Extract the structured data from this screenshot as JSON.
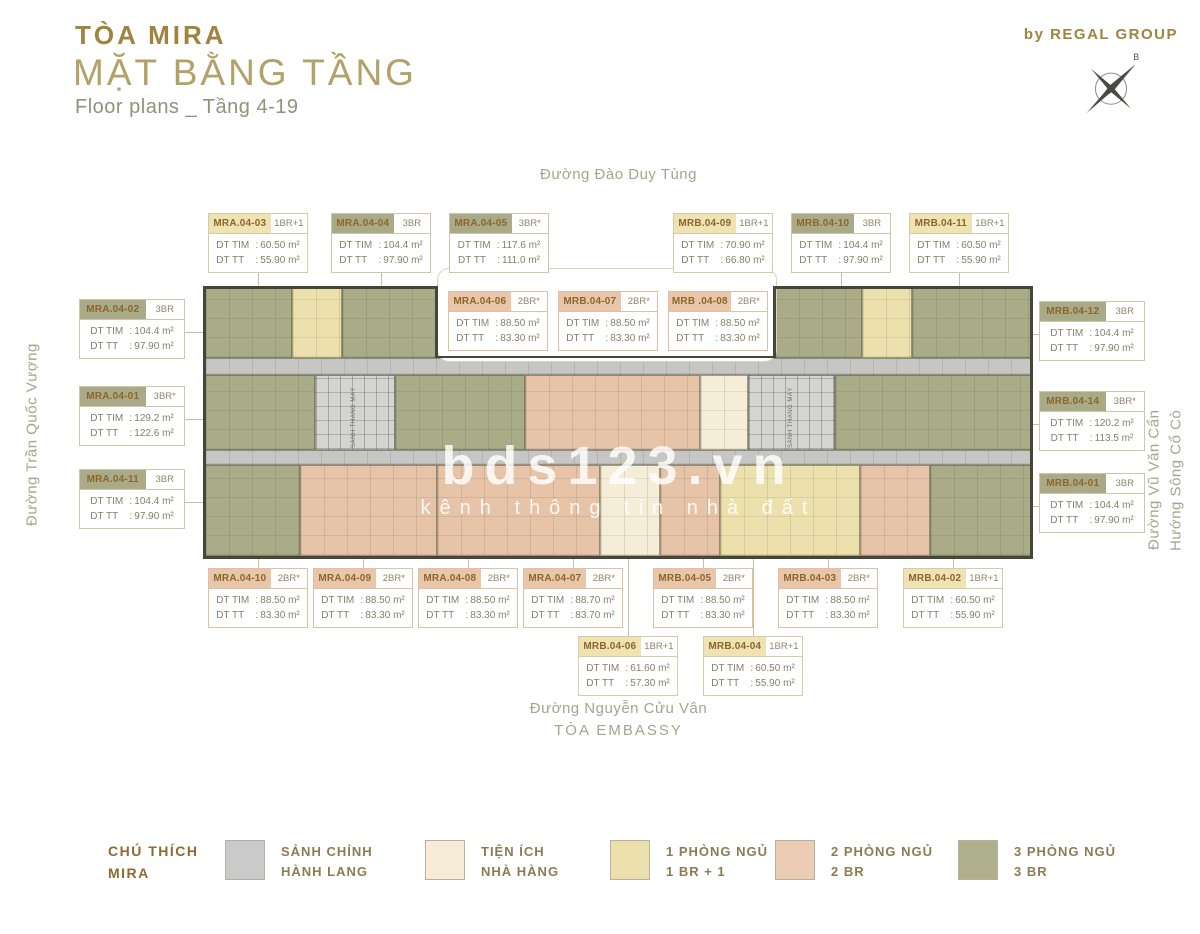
{
  "header": {
    "title": "TÒA MIRA",
    "subtitle": "MẶT BẰNG TẦNG",
    "range": "Floor plans _ Tầng 4-19",
    "byline": "by REGAL GROUP"
  },
  "compass": {
    "north": "B"
  },
  "streets": {
    "top": "Đường Đào Duy Tùng",
    "left": "Đường Trần Quốc Vượng",
    "right1": "Đường Vũ Văn Cẩn",
    "right2": "Hướng Sông Cổ Cò",
    "bottom1": "Đường Nguyễn Cửu Vân",
    "bottom2": "TÒA EMBASSY"
  },
  "watermark": {
    "brand": "bds123.vn",
    "tagline": "kênh thông tin nhà đất"
  },
  "plan": {
    "core_label": "SẢNH THANG MÁY"
  },
  "labels": {
    "dt_tim": "DT TIM",
    "dt_tt": "DT TT"
  },
  "units": [
    {
      "code": "MRA.04-03",
      "type": "1BR+1",
      "tim": "60.50 m²",
      "tt": "55.90 m²",
      "color": "yellow"
    },
    {
      "code": "MRA.04-04",
      "type": "3BR",
      "tim": "104.4 m²",
      "tt": "97.90 m²",
      "color": "olive"
    },
    {
      "code": "MRA.04-05",
      "type": "3BR*",
      "tim": "117.6 m²",
      "tt": "111.0 m²",
      "color": "olive"
    },
    {
      "code": "MRB.04-09",
      "type": "1BR+1",
      "tim": "70.90 m²",
      "tt": "66.80 m²",
      "color": "yellow"
    },
    {
      "code": "MRB.04-10",
      "type": "3BR",
      "tim": "104.4 m²",
      "tt": "97.90 m²",
      "color": "olive"
    },
    {
      "code": "MRB.04-11",
      "type": "1BR+1",
      "tim": "60.50 m²",
      "tt": "55.90 m²",
      "color": "yellow"
    },
    {
      "code": "MRA.04-06",
      "type": "2BR*",
      "tim": "88.50 m²",
      "tt": "83.30 m²",
      "color": "peach"
    },
    {
      "code": "MRB.04-07",
      "type": "2BR*",
      "tim": "88.50 m²",
      "tt": "83.30 m²",
      "color": "peach"
    },
    {
      "code": "MRB .04-08",
      "type": "2BR*",
      "tim": "88.50 m²",
      "tt": "83.30 m²",
      "color": "peach"
    },
    {
      "code": "MRA.04-02",
      "type": "3BR",
      "tim": "104.4 m²",
      "tt": "97.90 m²",
      "color": "olive"
    },
    {
      "code": "MRA.04-01",
      "type": "3BR*",
      "tim": "129.2 m²",
      "tt": "122.6 m²",
      "color": "olive"
    },
    {
      "code": "MRA.04-11",
      "type": "3BR",
      "tim": "104.4 m²",
      "tt": "97.90 m²",
      "color": "olive"
    },
    {
      "code": "MRB.04-12",
      "type": "3BR",
      "tim": "104.4 m²",
      "tt": "97.90 m²",
      "color": "olive"
    },
    {
      "code": "MRB.04-14",
      "type": "3BR*",
      "tim": "120.2 m²",
      "tt": "113.5 m²",
      "color": "olive"
    },
    {
      "code": "MRB.04-01",
      "type": "3BR",
      "tim": "104.4 m²",
      "tt": "97.90 m²",
      "color": "olive"
    },
    {
      "code": "MRA.04-10",
      "type": "2BR*",
      "tim": "88.50 m²",
      "tt": "83.30 m²",
      "color": "peach"
    },
    {
      "code": "MRA.04-09",
      "type": "2BR*",
      "tim": "88.50 m²",
      "tt": "83.30 m²",
      "color": "peach"
    },
    {
      "code": "MRA.04-08",
      "type": "2BR*",
      "tim": "88.50 m²",
      "tt": "83.30 m²",
      "color": "peach"
    },
    {
      "code": "MRA.04-07",
      "type": "2BR*",
      "tim": "88.70 m²",
      "tt": "83.70 m²",
      "color": "peach"
    },
    {
      "code": "MRB.04-05",
      "type": "2BR*",
      "tim": "88.50 m²",
      "tt": "83.30 m²",
      "color": "peach"
    },
    {
      "code": "MRB.04-03",
      "type": "2BR*",
      "tim": "88.50 m²",
      "tt": "83.30 m²",
      "color": "peach"
    },
    {
      "code": "MRB.04-02",
      "type": "1BR+1",
      "tim": "60.50 m²",
      "tt": "55.90 m²",
      "color": "yellow"
    },
    {
      "code": "MRB.04-06",
      "type": "1BR+1",
      "tim": "61.60 m²",
      "tt": "57.30 m²",
      "color": "yellow"
    },
    {
      "code": "MRB.04-04",
      "type": "1BR+1",
      "tim": "60.50 m²",
      "tt": "55.90 m²",
      "color": "yellow"
    }
  ],
  "legend": {
    "title1": "CHÚ THÍCH",
    "title2": "MIRA",
    "items": [
      {
        "line1": "SẢNH CHỈNH",
        "line2": "HÀNH LANG",
        "color": "#c9cac9"
      },
      {
        "line1": "TIỆN ÍCH",
        "line2": "NHÀ HÀNG",
        "color": "#f7ecd5"
      },
      {
        "line1": "1 PHÒNG NGỦ",
        "line2": "1 BR + 1",
        "color": "#ece0ad"
      },
      {
        "line1": "2 PHÒNG NGỦ",
        "line2": "2 BR",
        "color": "#eccdb3"
      },
      {
        "line1": "3 PHÒNG NGỦ",
        "line2": "3 BR",
        "color": "#aeb18c"
      }
    ]
  },
  "colors": {
    "olive": "#a9ac87",
    "yellow": "#ece1ad",
    "peach": "#e7c3a7",
    "gray": "#c6c6c4",
    "cream": "#f6edd8",
    "core": "#d4d4d2",
    "header_olive": "#a9aa87",
    "header_yellow": "#efe3b4",
    "header_peach": "#e9c6aa",
    "accent_gold": "#9f8440"
  }
}
